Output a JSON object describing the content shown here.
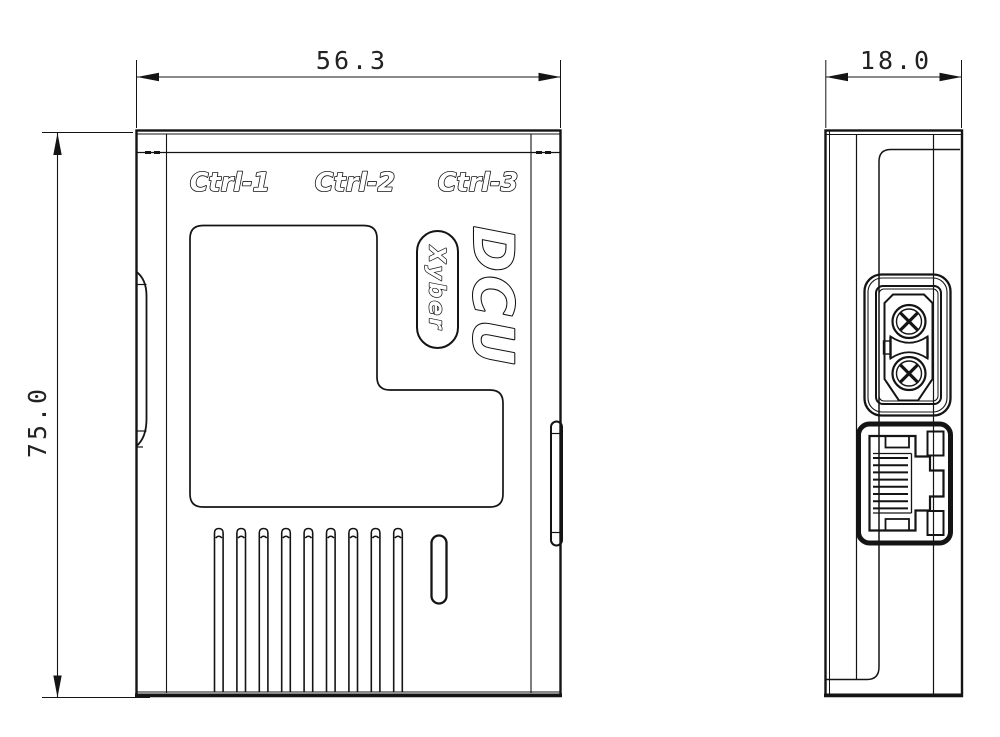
{
  "front_view": {
    "width_dim": "56.3",
    "height_dim": "75.0",
    "ctrl_labels": {
      "c1": "Ctrl-1",
      "c2": "Ctrl-2",
      "c3": "Ctrl-3"
    },
    "product_name": "DCU",
    "brand": "Xyber",
    "vent_slot_count": 9
  },
  "side_view": {
    "depth_dim": "18.0",
    "connectors": [
      "power-terminal-connector",
      "rj45-ethernet-port"
    ]
  },
  "colors": {
    "line": "#141414",
    "background": "#ffffff",
    "dim_text": "#222222"
  }
}
